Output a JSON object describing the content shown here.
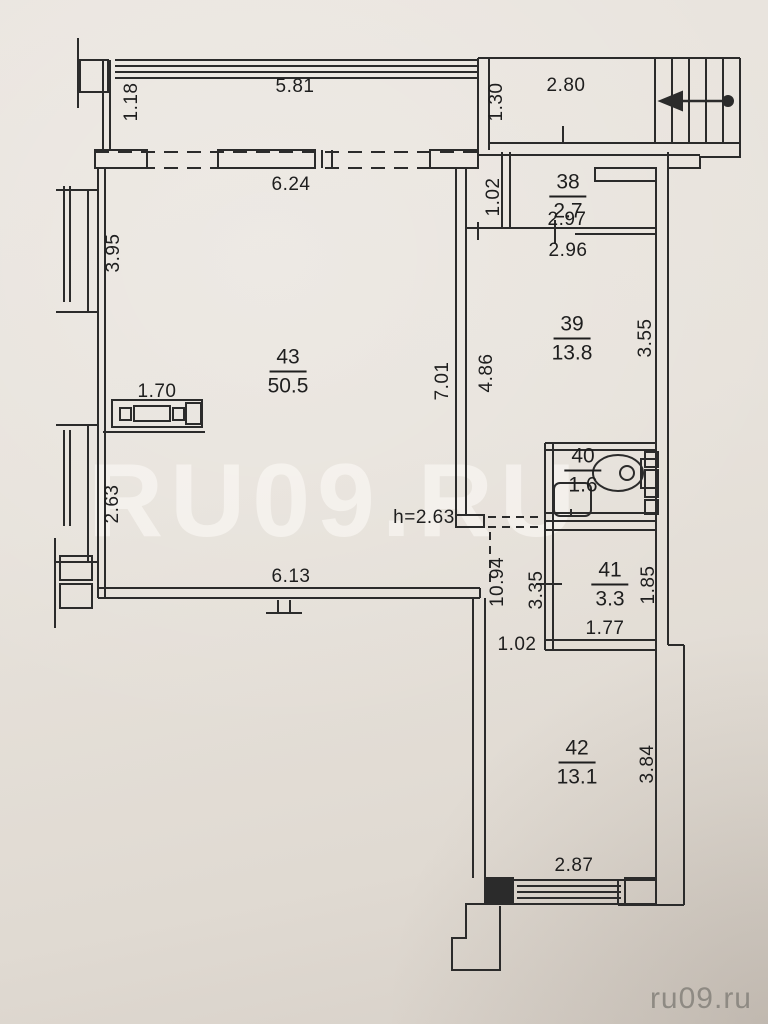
{
  "watermarks": {
    "center": "RU09.RU",
    "corner": "ru09.ru"
  },
  "rooms": {
    "r43": {
      "number": "43",
      "area": "50.5"
    },
    "r38": {
      "number": "38",
      "area": "2.7"
    },
    "r39": {
      "number": "39",
      "area": "13.8"
    },
    "r40": {
      "number": "40",
      "area": "1.6"
    },
    "r41": {
      "number": "41",
      "area": "3.3"
    },
    "r42": {
      "number": "42",
      "area": "13.1"
    }
  },
  "dims": {
    "balcony_width": "5.81",
    "balcony_depth": "1.18",
    "landing_width": "2.80",
    "landing_depth": "1.30",
    "room43_top_width": "6.24",
    "room38_height": "1.02",
    "room38_width": "2.97",
    "room39_width": "2.96",
    "room39_height_left": "4.86",
    "room39_height_right": "3.55",
    "central_wall_height": "7.01",
    "window_upper": "3.95",
    "window_lower": "2.63",
    "counter_width": "1.70",
    "ceiling_height": "h=2.63",
    "room43_bottom_width": "6.13",
    "hall_height": "10.94",
    "room41_height_left": "3.35",
    "room41_height_right": "1.85",
    "room41_width": "1.77",
    "hall_door_width": "1.02",
    "room42_height": "3.84",
    "room42_width": "2.87"
  }
}
